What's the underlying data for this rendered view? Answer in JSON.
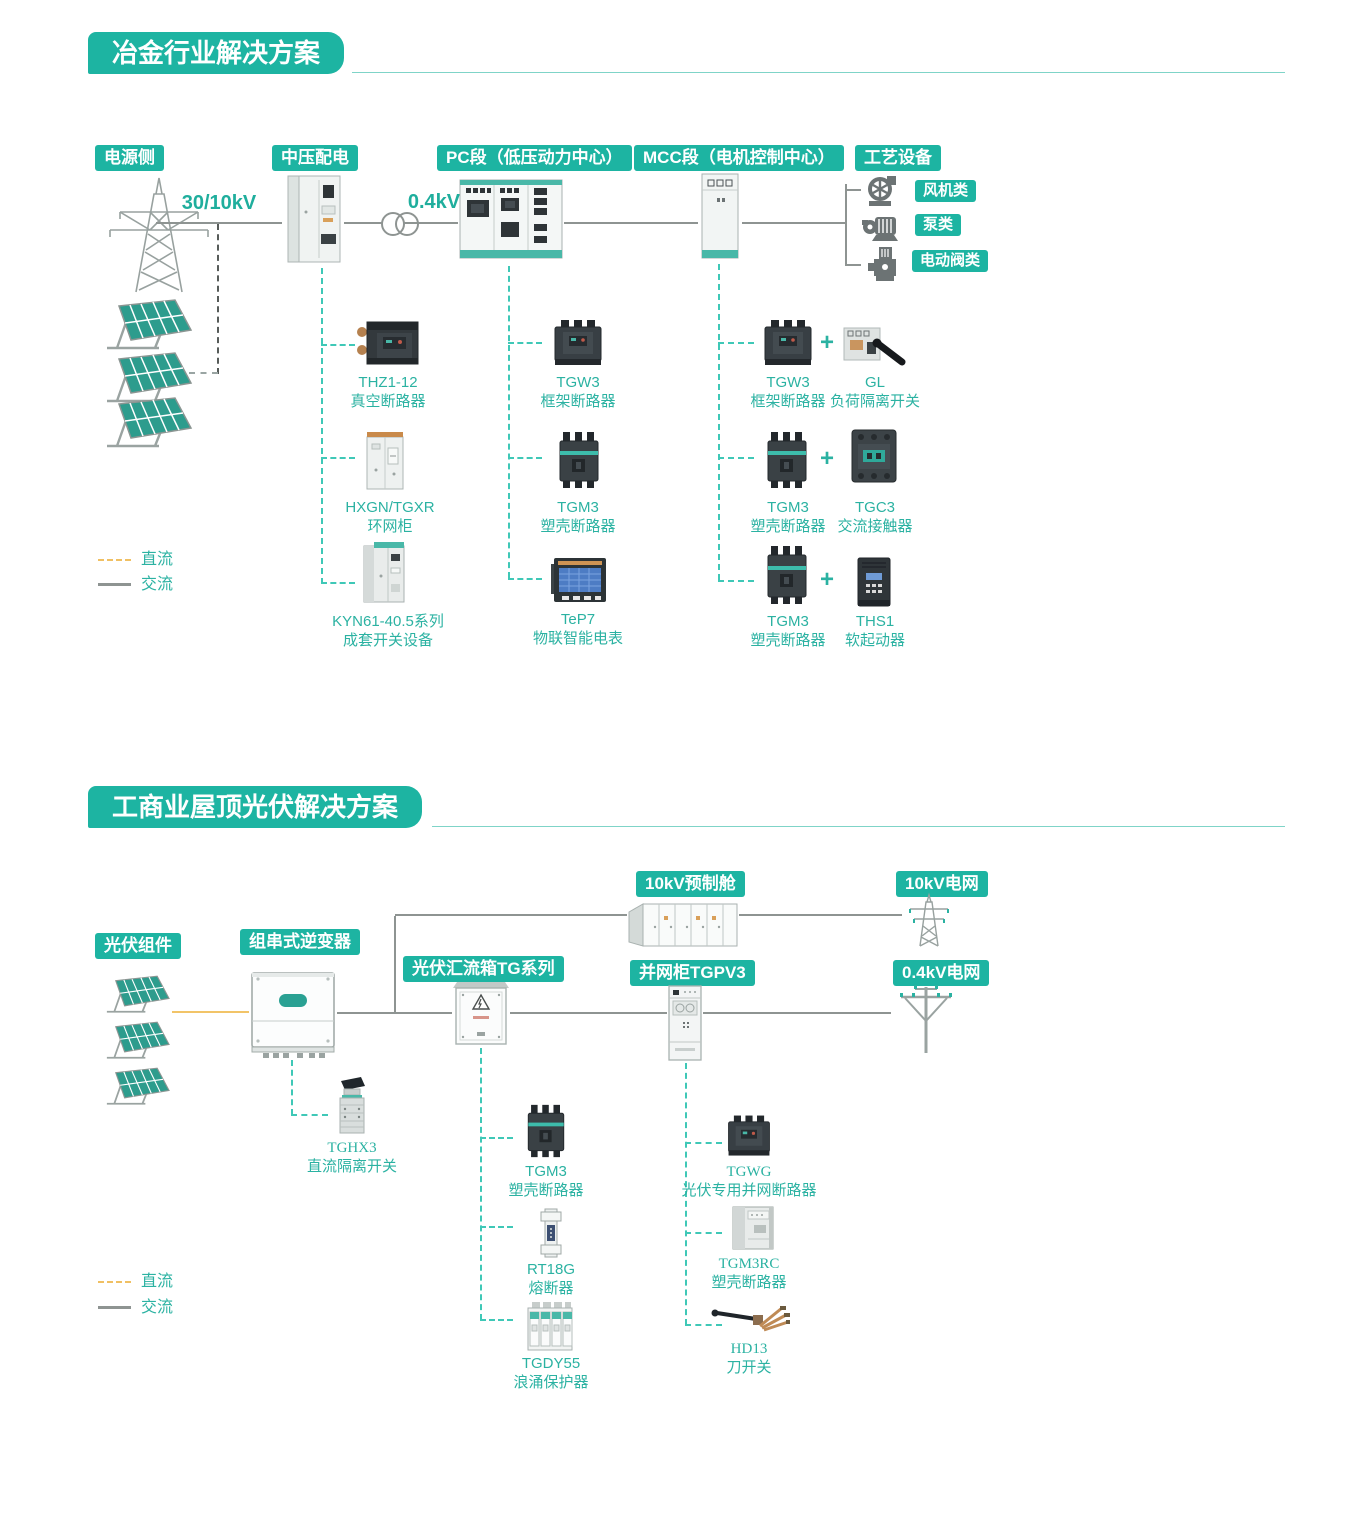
{
  "colors": {
    "badge_teal": "#1db4a2",
    "label_teal": "#2bb2a2",
    "dc_orange": "#f2c468",
    "ac_gray": "#8e9492",
    "dash_teal": "#3fc8b7"
  },
  "section1": {
    "title": "冶金行业解决方案",
    "headers": {
      "power_side": "电源侧",
      "mv_distribution": "中压配电",
      "pc_section": "PC段（低压动力中心）",
      "mcc_section": "MCC段（电机控制中心）",
      "process_equipment": "工艺设备"
    },
    "voltages": {
      "incoming": "30/10kV",
      "lv": "0.4kV"
    },
    "equipment_types": [
      {
        "label": "风机类"
      },
      {
        "label": "泵类"
      },
      {
        "label": "电动阀类"
      }
    ],
    "mv_products": [
      {
        "model": "THZ1-12",
        "name": "真空断路器"
      },
      {
        "model": "HXGN/TGXR",
        "name": "环网柜"
      },
      {
        "model": "KYN61-40.5系列",
        "name": "成套开关设备"
      }
    ],
    "pc_products": [
      {
        "model": "TGW3",
        "name": "框架断路器"
      },
      {
        "model": "TGM3",
        "name": "塑壳断路器"
      },
      {
        "model": "TeP7",
        "name": "物联智能电表"
      }
    ],
    "mcc_pairs": [
      {
        "model_a": "TGW3",
        "name_a": "框架断路器",
        "model_b": "GL",
        "name_b": "负荷隔离开关"
      },
      {
        "model_a": "TGM3",
        "name_a": "塑壳断路器",
        "model_b": "TGC3",
        "name_b": "交流接触器"
      },
      {
        "model_a": "TGM3",
        "name_a": "塑壳断路器",
        "model_b": "THS1",
        "name_b": "软起动器"
      }
    ],
    "plus": "+",
    "legend": {
      "dc": "直流",
      "ac": "交流"
    }
  },
  "section2": {
    "title": "工商业屋顶光伏解决方案",
    "headers": {
      "pv_modules": "光伏组件",
      "string_inverter": "组串式逆变器",
      "combiner_box": "光伏汇流箱TG系列",
      "grid_cabinet": "并网柜TGPV3",
      "prefab_cabin": "10kV预制舱",
      "grid_10kv": "10kV电网",
      "grid_04kv": "0.4kV电网"
    },
    "inverter_product": {
      "model": "TGHX3",
      "name": "直流隔离开关"
    },
    "combiner_products": [
      {
        "model": "TGM3",
        "name": "塑壳断路器"
      },
      {
        "model": "RT18G",
        "name": "熔断器"
      },
      {
        "model": "TGDY55",
        "name": "浪涌保护器"
      }
    ],
    "grid_products": [
      {
        "model": "TGWG",
        "name": "光伏专用并网断路器"
      },
      {
        "model": "TGM3RC",
        "name": "塑壳断路器"
      },
      {
        "model": "HD13",
        "name": "刀开关"
      }
    ],
    "legend": {
      "dc": "直流",
      "ac": "交流"
    }
  }
}
